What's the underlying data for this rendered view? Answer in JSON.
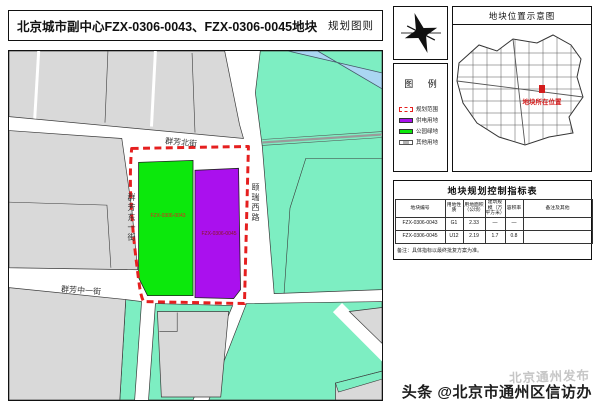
{
  "sheet": {
    "title": "北京城市副中心FZX-0306-0043、FZX-0306-0045地块",
    "doc_type": "规划图则"
  },
  "map": {
    "street_north": "群芳北街",
    "street_west": "群芳东一街",
    "street_south": "群芳中一街",
    "road_east": "颐瑞西路",
    "plots": [
      {
        "id": "FZX-0306-0043",
        "use": "公园绿地",
        "color": "#0ce80c"
      },
      {
        "id": "FZX-0306-0045",
        "use": "供电用地",
        "color": "#aa10ee"
      }
    ],
    "colors": {
      "existing_block": "#d9d9d9",
      "green_space": "#7deec2",
      "water": "#aad6f2",
      "boundary_dash": "#e51f1f"
    }
  },
  "location_map": {
    "title": "地块位置示意图",
    "marker_label": "地块所在位置",
    "marker_color": "#d31c1c"
  },
  "legend": {
    "title": "图 例",
    "items": [
      {
        "label": "规划范围",
        "type": "dashed-red"
      },
      {
        "label": "供电用地",
        "color": "#aa10ee"
      },
      {
        "label": "公园绿地",
        "color": "#0ce80c"
      },
      {
        "label": "其他用地",
        "color": "#ededed"
      }
    ]
  },
  "table": {
    "title": "地块规划控制指标表",
    "columns": [
      "地块编号",
      "用地性质",
      "用地面积（公顷）",
      "建筑规模（万平方米）",
      "容积率",
      "备注及其他"
    ],
    "rows": [
      [
        "FZX-0306-0043",
        "G1",
        "2.33",
        "—",
        "—",
        ""
      ],
      [
        "FZX-0306-0045",
        "U12",
        "2.19",
        "1.7",
        "0.8",
        ""
      ]
    ],
    "note": "备注：具体指标以最终批复方案为准。"
  },
  "watermark": {
    "faint": "北京通州发布",
    "main": "头条 @北京市通州区信访办"
  }
}
